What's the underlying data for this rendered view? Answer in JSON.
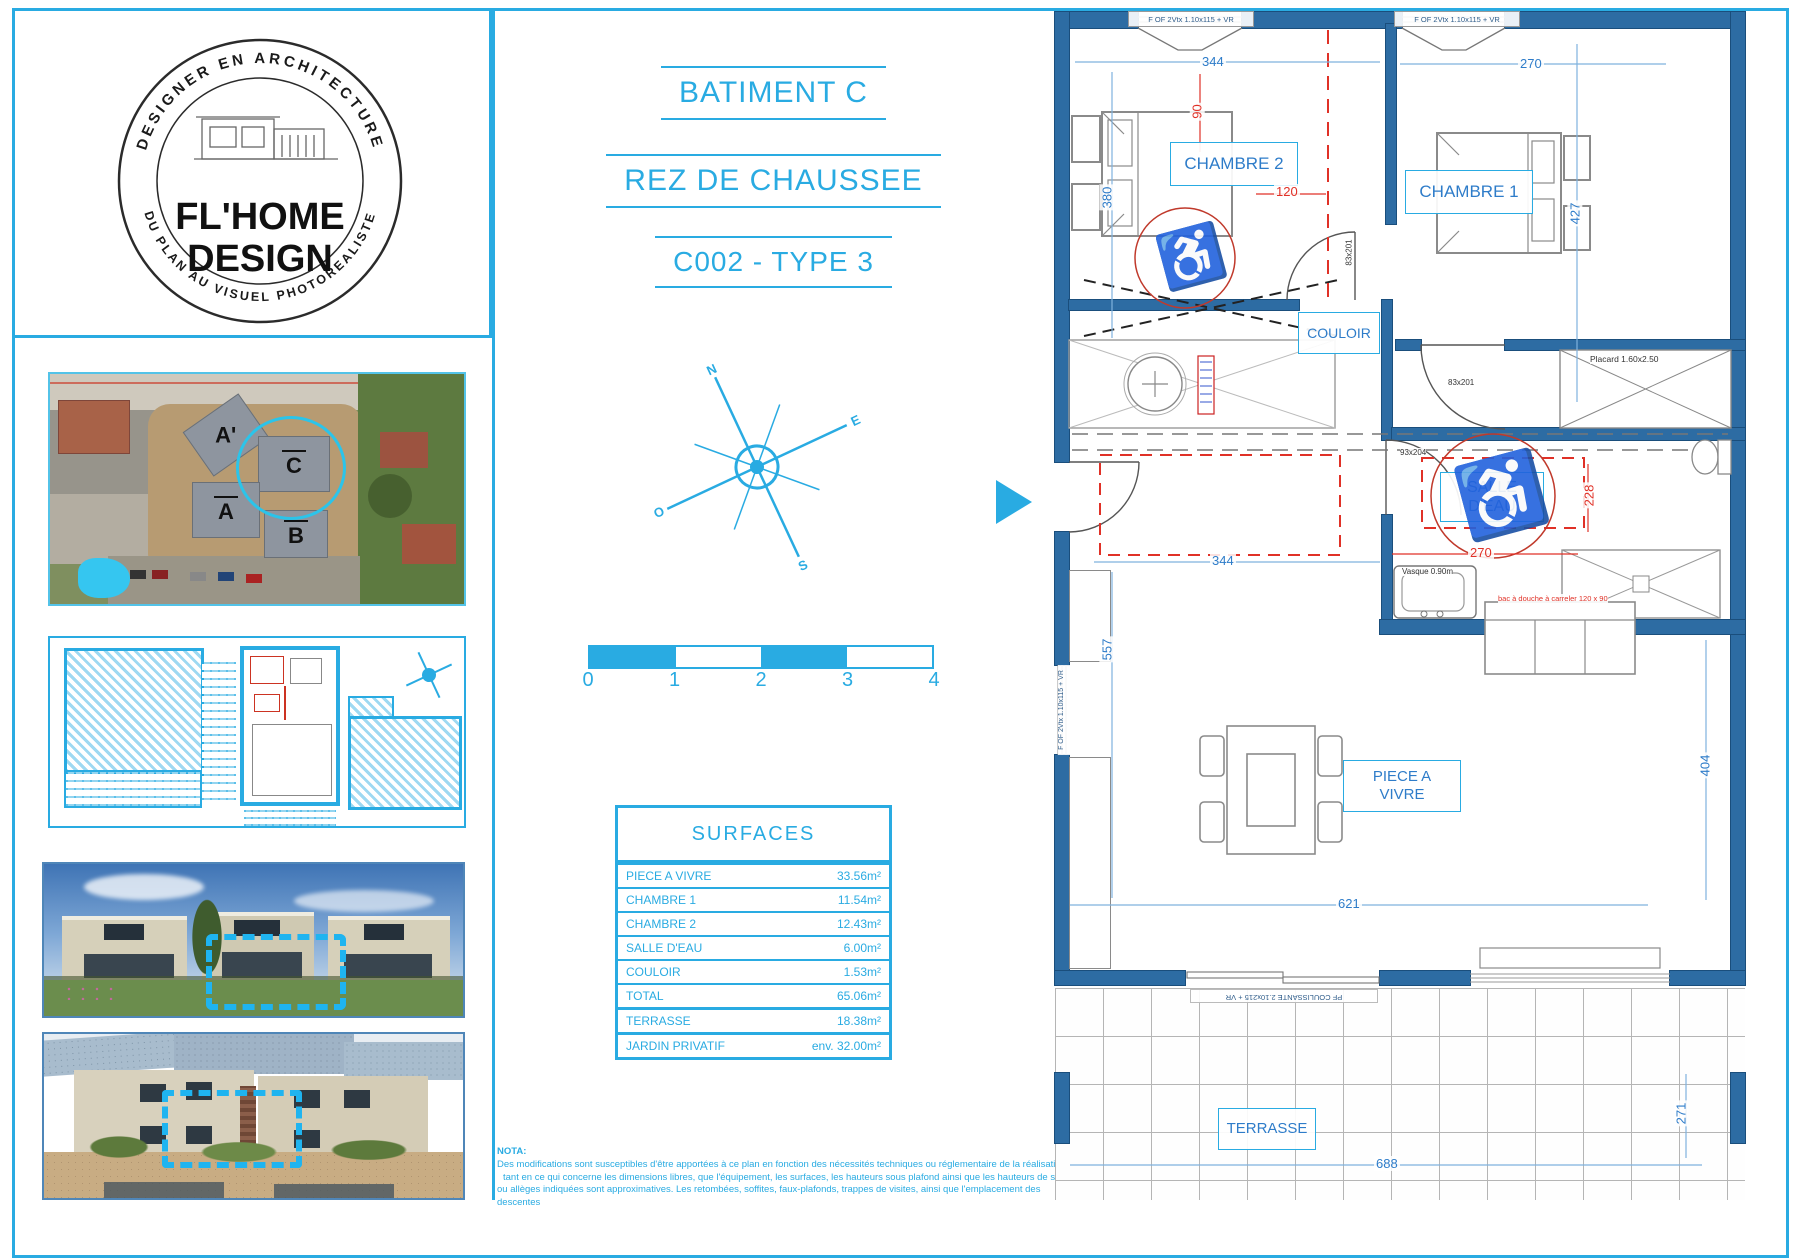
{
  "colors": {
    "accent": "#29abe2",
    "wall": "#2d6ca3",
    "wall_dark": "#1a4e7c",
    "dim_blue": "#2e7cc9",
    "dim_red": "#e03127"
  },
  "logo": {
    "top_arc": "DESIGNER EN ARCHITECTURE",
    "name1": "FL'HOME",
    "name2": "DESIGN",
    "bottom_arc": "DU PLAN AU VISUEL PHOTOREALISTE"
  },
  "titles": {
    "building": "BATIMENT C",
    "floor": "REZ DE CHAUSSEE",
    "unit": "C002 - TYPE 3"
  },
  "aerial": {
    "a_prime": "A'",
    "c": "C",
    "a": "A",
    "b": "B"
  },
  "compass": {
    "n": "N",
    "s": "S",
    "e": "E",
    "o": "O"
  },
  "scale": {
    "t0": "0",
    "t1": "1",
    "t2": "2",
    "t3": "3",
    "t4": "4"
  },
  "surfaces": {
    "title": "SURFACES",
    "rows": [
      {
        "label": "PIECE A VIVRE",
        "value": "33.56m²"
      },
      {
        "label": "CHAMBRE 1",
        "value": "11.54m²"
      },
      {
        "label": "CHAMBRE 2",
        "value": "12.43m²"
      },
      {
        "label": "SALLE D'EAU",
        "value": "6.00m²"
      },
      {
        "label": "COULOIR",
        "value": "1.53m²"
      },
      {
        "label": "TOTAL",
        "value": "65.06m²"
      },
      {
        "label": "TERRASSE",
        "value": "18.38m²"
      },
      {
        "label": "JARDIN PRIVATIF",
        "value": "env. 32.00m²"
      }
    ]
  },
  "nota": {
    "title": "NOTA:",
    "l1": "Des modifications sont susceptibles d'être apportées à ce plan en fonction des nécessités techniques ou réglementaire de la réalisation,",
    "l2": "tant en ce qui concerne les dimensions libres, que l'équipement, les surfaces, les hauteurs sous plafond ainsi que les hauteurs de seuils",
    "l3": "ou allèges indiquées sont approximatives. Les retombées, soffites, faux-plafonds, trappes de visites, ainsi que l'emplacement des descentes"
  },
  "plan": {
    "rooms": {
      "chambre2": "CHAMBRE 2",
      "chambre1": "CHAMBRE 1",
      "couloir": "COULOIR",
      "salle_deau": "SALLE D'EAU",
      "piece_a_vivre": "PIECE A VIVRE",
      "terrasse": "TERRASSE"
    },
    "dims": {
      "d344a": "344",
      "d270a": "270",
      "d380": "380",
      "d90": "90",
      "d120": "120",
      "d427": "427",
      "d344b": "344",
      "d270b": "270",
      "d228": "228",
      "d557": "557",
      "d621": "621",
      "d404": "404",
      "d688": "688",
      "d271": "271"
    },
    "labels": {
      "window": "F OF 2Vtx 1.10x115 + VR",
      "sliding": "PF COULISSANTE 2.10x215 + VR",
      "placard": "Placard 1.60x2.50",
      "vasque": "Vasque 0.90m",
      "shower": "bac à douche à carreler 120 x 90",
      "door_a": "83x201",
      "door_b": "93x204"
    },
    "symbols": {
      "wheelchair": "♿"
    }
  }
}
